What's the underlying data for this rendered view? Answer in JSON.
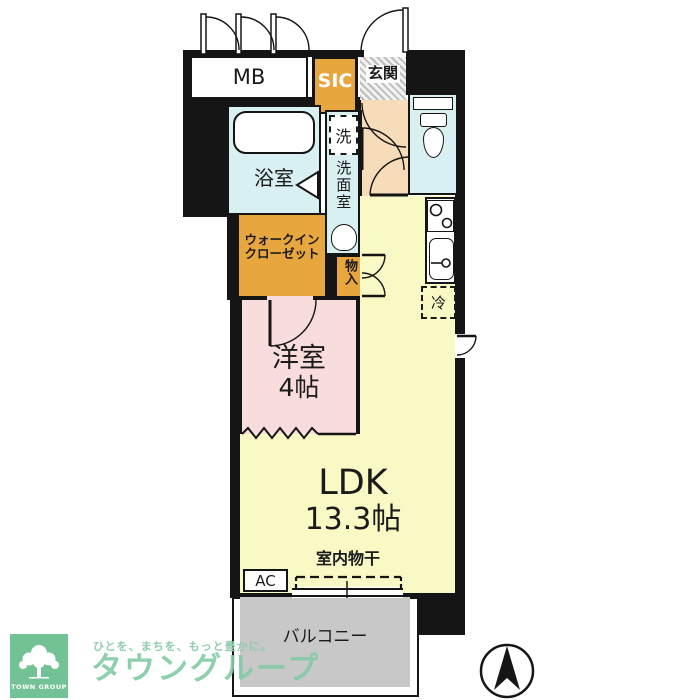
{
  "floorplan": {
    "rooms": {
      "mb": "MB",
      "sic": "SIC",
      "entrance": "玄関",
      "washing_machine": "洗",
      "washroom": "洗面室",
      "bathroom": "浴室",
      "walk_in_closet_line1": "ウォークイン",
      "walk_in_closet_line2": "クローゼット",
      "storage": "物入",
      "western_room_name": "洋室",
      "western_room_size": "4帖",
      "ldk_name": "LDK",
      "ldk_size": "13.3帖",
      "refrigerator": "冷",
      "indoor_drying": "室内物干",
      "air_conditioner": "AC",
      "balcony": "バルコニー"
    },
    "colors": {
      "wall": "#151515",
      "closet_orange": "#e8a73e",
      "hall_peach": "#f7dcba",
      "water_blue": "#d8f0f2",
      "room_pink": "#f9dcdc",
      "ldk_yellow": "#f9f9c6",
      "balcony_gray": "#c8c8c8"
    }
  },
  "branding": {
    "logo_box_text": "TOWN GROUP",
    "tagline": "ひとを、まちを、もっと豊かに。",
    "brand_name": "タウングループ",
    "brand_green": "#7cc79c"
  }
}
